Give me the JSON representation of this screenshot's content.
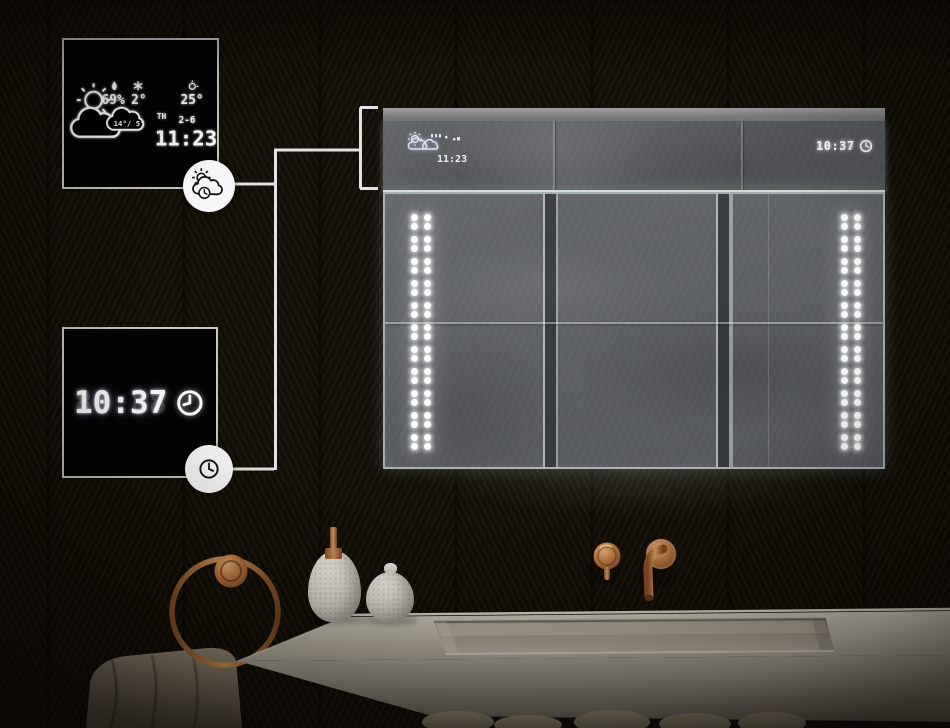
{
  "scene": {
    "description": "LED bathroom mirror cabinet with weather station and clock displays above a stone washbasin",
    "accent_copper": "#b5713d",
    "led_white": "#ffffff",
    "wall_dark": "#16110d",
    "counter_beige": "#b9b1a1",
    "mirror_gray": "#5f6266"
  },
  "weather_callout": {
    "humidity": "69%",
    "outdoor_temp": "2°",
    "forecast_high_low": "14°/ 5°",
    "indoor_temp": "25°",
    "weekday": "TH",
    "date": "2-6",
    "time": "11:23"
  },
  "clock_callout": {
    "time": "10:37",
    "ghost_segments": "88:88"
  },
  "mirror": {
    "weather_time": "11:23",
    "clock_time": "10:37",
    "clock_ghost": "88:88",
    "led": {
      "strips": 2,
      "groups_per_strip": 11,
      "dots_per_group": 4
    }
  }
}
